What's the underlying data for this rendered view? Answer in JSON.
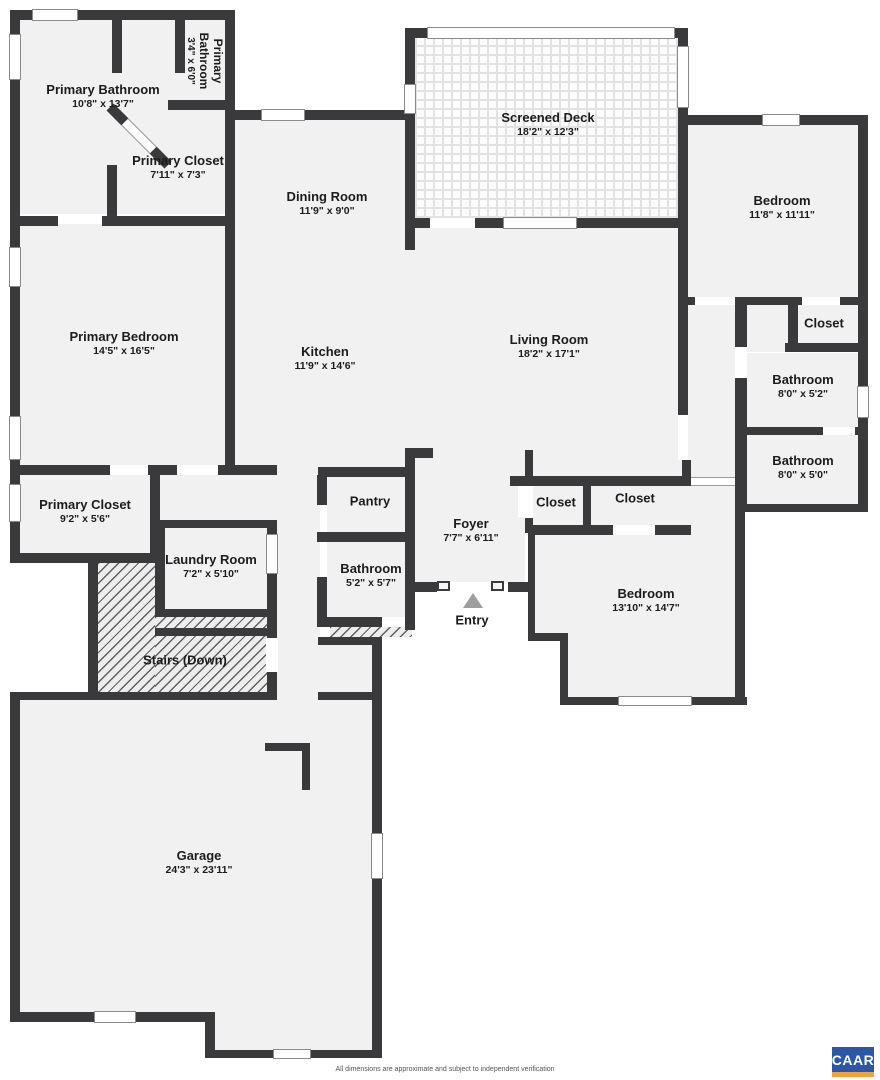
{
  "plan": {
    "rooms": [
      {
        "name": "Primary Bathroom",
        "dims": "10'8\" x 13'7\""
      },
      {
        "name": "Primary Bathroom",
        "dims": "3'4\" x 6'0\""
      },
      {
        "name": "Primary Closet",
        "dims": "7'11\" x 7'3\""
      },
      {
        "name": "Dining Room",
        "dims": "11'9\" x 9'0\""
      },
      {
        "name": "Screened Deck",
        "dims": "18'2\" x 12'3\""
      },
      {
        "name": "Bedroom",
        "dims": "11'8\" x 11'11\""
      },
      {
        "name": "Closet",
        "dims": ""
      },
      {
        "name": "Bathroom",
        "dims": "8'0\" x 5'2\""
      },
      {
        "name": "Bathroom",
        "dims": "8'0\" x 5'0\""
      },
      {
        "name": "Primary Bedroom",
        "dims": "14'5\" x 16'5\""
      },
      {
        "name": "Kitchen",
        "dims": "11'9\" x 14'6\""
      },
      {
        "name": "Living Room",
        "dims": "18'2\" x 17'1\""
      },
      {
        "name": "Primary Closet",
        "dims": "9'2\" x 5'6\""
      },
      {
        "name": "Laundry Room",
        "dims": "7'2\" x 5'10\""
      },
      {
        "name": "Pantry",
        "dims": ""
      },
      {
        "name": "Bathroom",
        "dims": "5'2\" x 5'7\""
      },
      {
        "name": "Foyer",
        "dims": "7'7\" x 6'11\""
      },
      {
        "name": "Closet",
        "dims": ""
      },
      {
        "name": "Closet",
        "dims": ""
      },
      {
        "name": "Bedroom",
        "dims": "13'10\" x 14'7\""
      },
      {
        "name": "Stairs (Down)",
        "dims": ""
      },
      {
        "name": "Garage",
        "dims": "24'3\" x 23'11\""
      },
      {
        "name": "Entry",
        "dims": ""
      }
    ],
    "footer": "All dimensions are approximate and subject to independent verification",
    "logo": "CAAR",
    "colors": {
      "wall": "#3a3a3c",
      "floor": "#f1f1f2",
      "logo_blue": "#2b57a5",
      "logo_orange": "#f0a23c"
    }
  }
}
